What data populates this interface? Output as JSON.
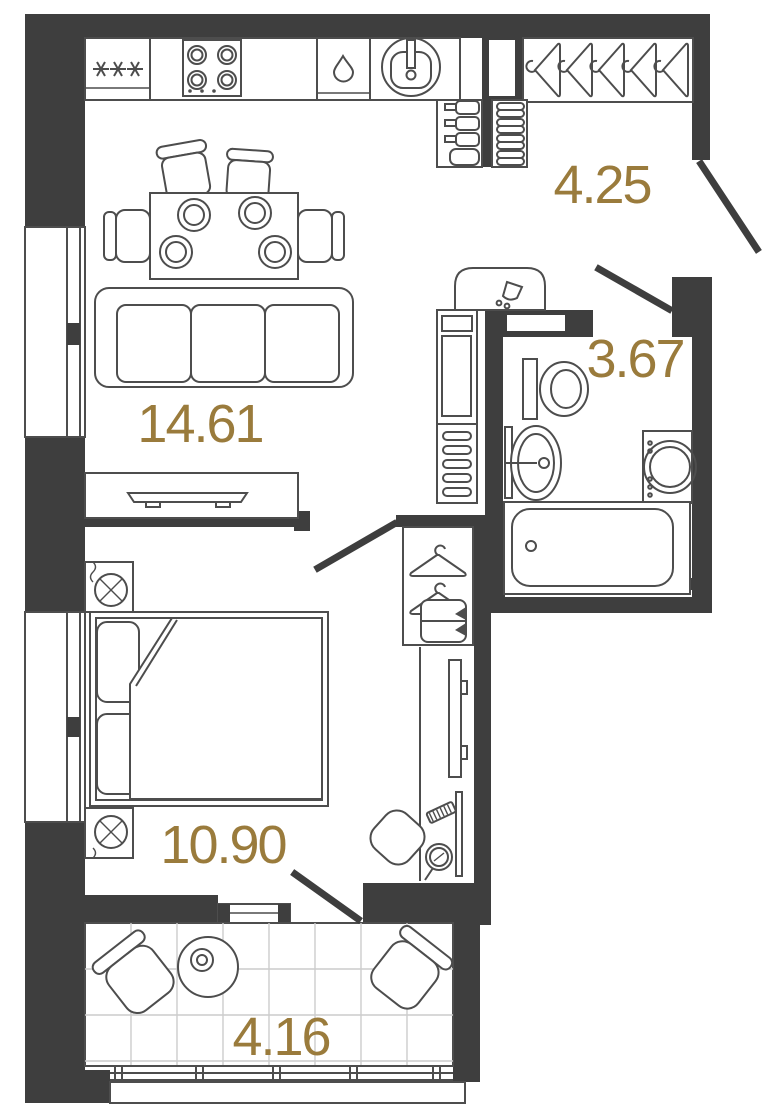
{
  "plan": {
    "type": "apartment-floor-plan",
    "colors": {
      "wall": "#3e3e3e",
      "outline": "#4d4d4d",
      "tile_grid": "#cccccc",
      "room_label": "#9a7b3c",
      "background": "#ffffff"
    },
    "rooms": {
      "kitchen_living": {
        "name": "kitchen-living-room",
        "area": "14.61"
      },
      "hallway": {
        "name": "hallway",
        "area": "4.25"
      },
      "bathroom": {
        "name": "bathroom",
        "area": "3.67"
      },
      "bedroom": {
        "name": "bedroom",
        "area": "10.90"
      },
      "balcony": {
        "name": "balcony",
        "area": "4.16"
      }
    },
    "doors": [
      "entrance-door",
      "bathroom-door",
      "bedroom-door",
      "balcony-door"
    ],
    "furniture": {
      "kitchen": [
        "fridge",
        "hob",
        "dishwasher",
        "kitchen-sink"
      ],
      "hallway": [
        "hanger-wardrobe",
        "bottle-shelf",
        "shoe-rack",
        "duct-shaft"
      ],
      "bathroom": [
        "water-heater",
        "toilet",
        "washbasin",
        "washing-machine",
        "bathtub",
        "cabinet",
        "towel-radiator"
      ],
      "living": [
        "dining-table",
        "dining-chairs",
        "plates",
        "sofa",
        "tv-stand",
        "tv"
      ],
      "bedroom": [
        "double-bed",
        "pillows",
        "blanket",
        "nightstand-with-lamp",
        "wardrobe",
        "wall-tv",
        "dressing-table",
        "hand-mirror",
        "hairbrush",
        "chair"
      ],
      "balcony": [
        "armchair",
        "round-table",
        "cup",
        "tiled-floor",
        "railing"
      ]
    }
  }
}
